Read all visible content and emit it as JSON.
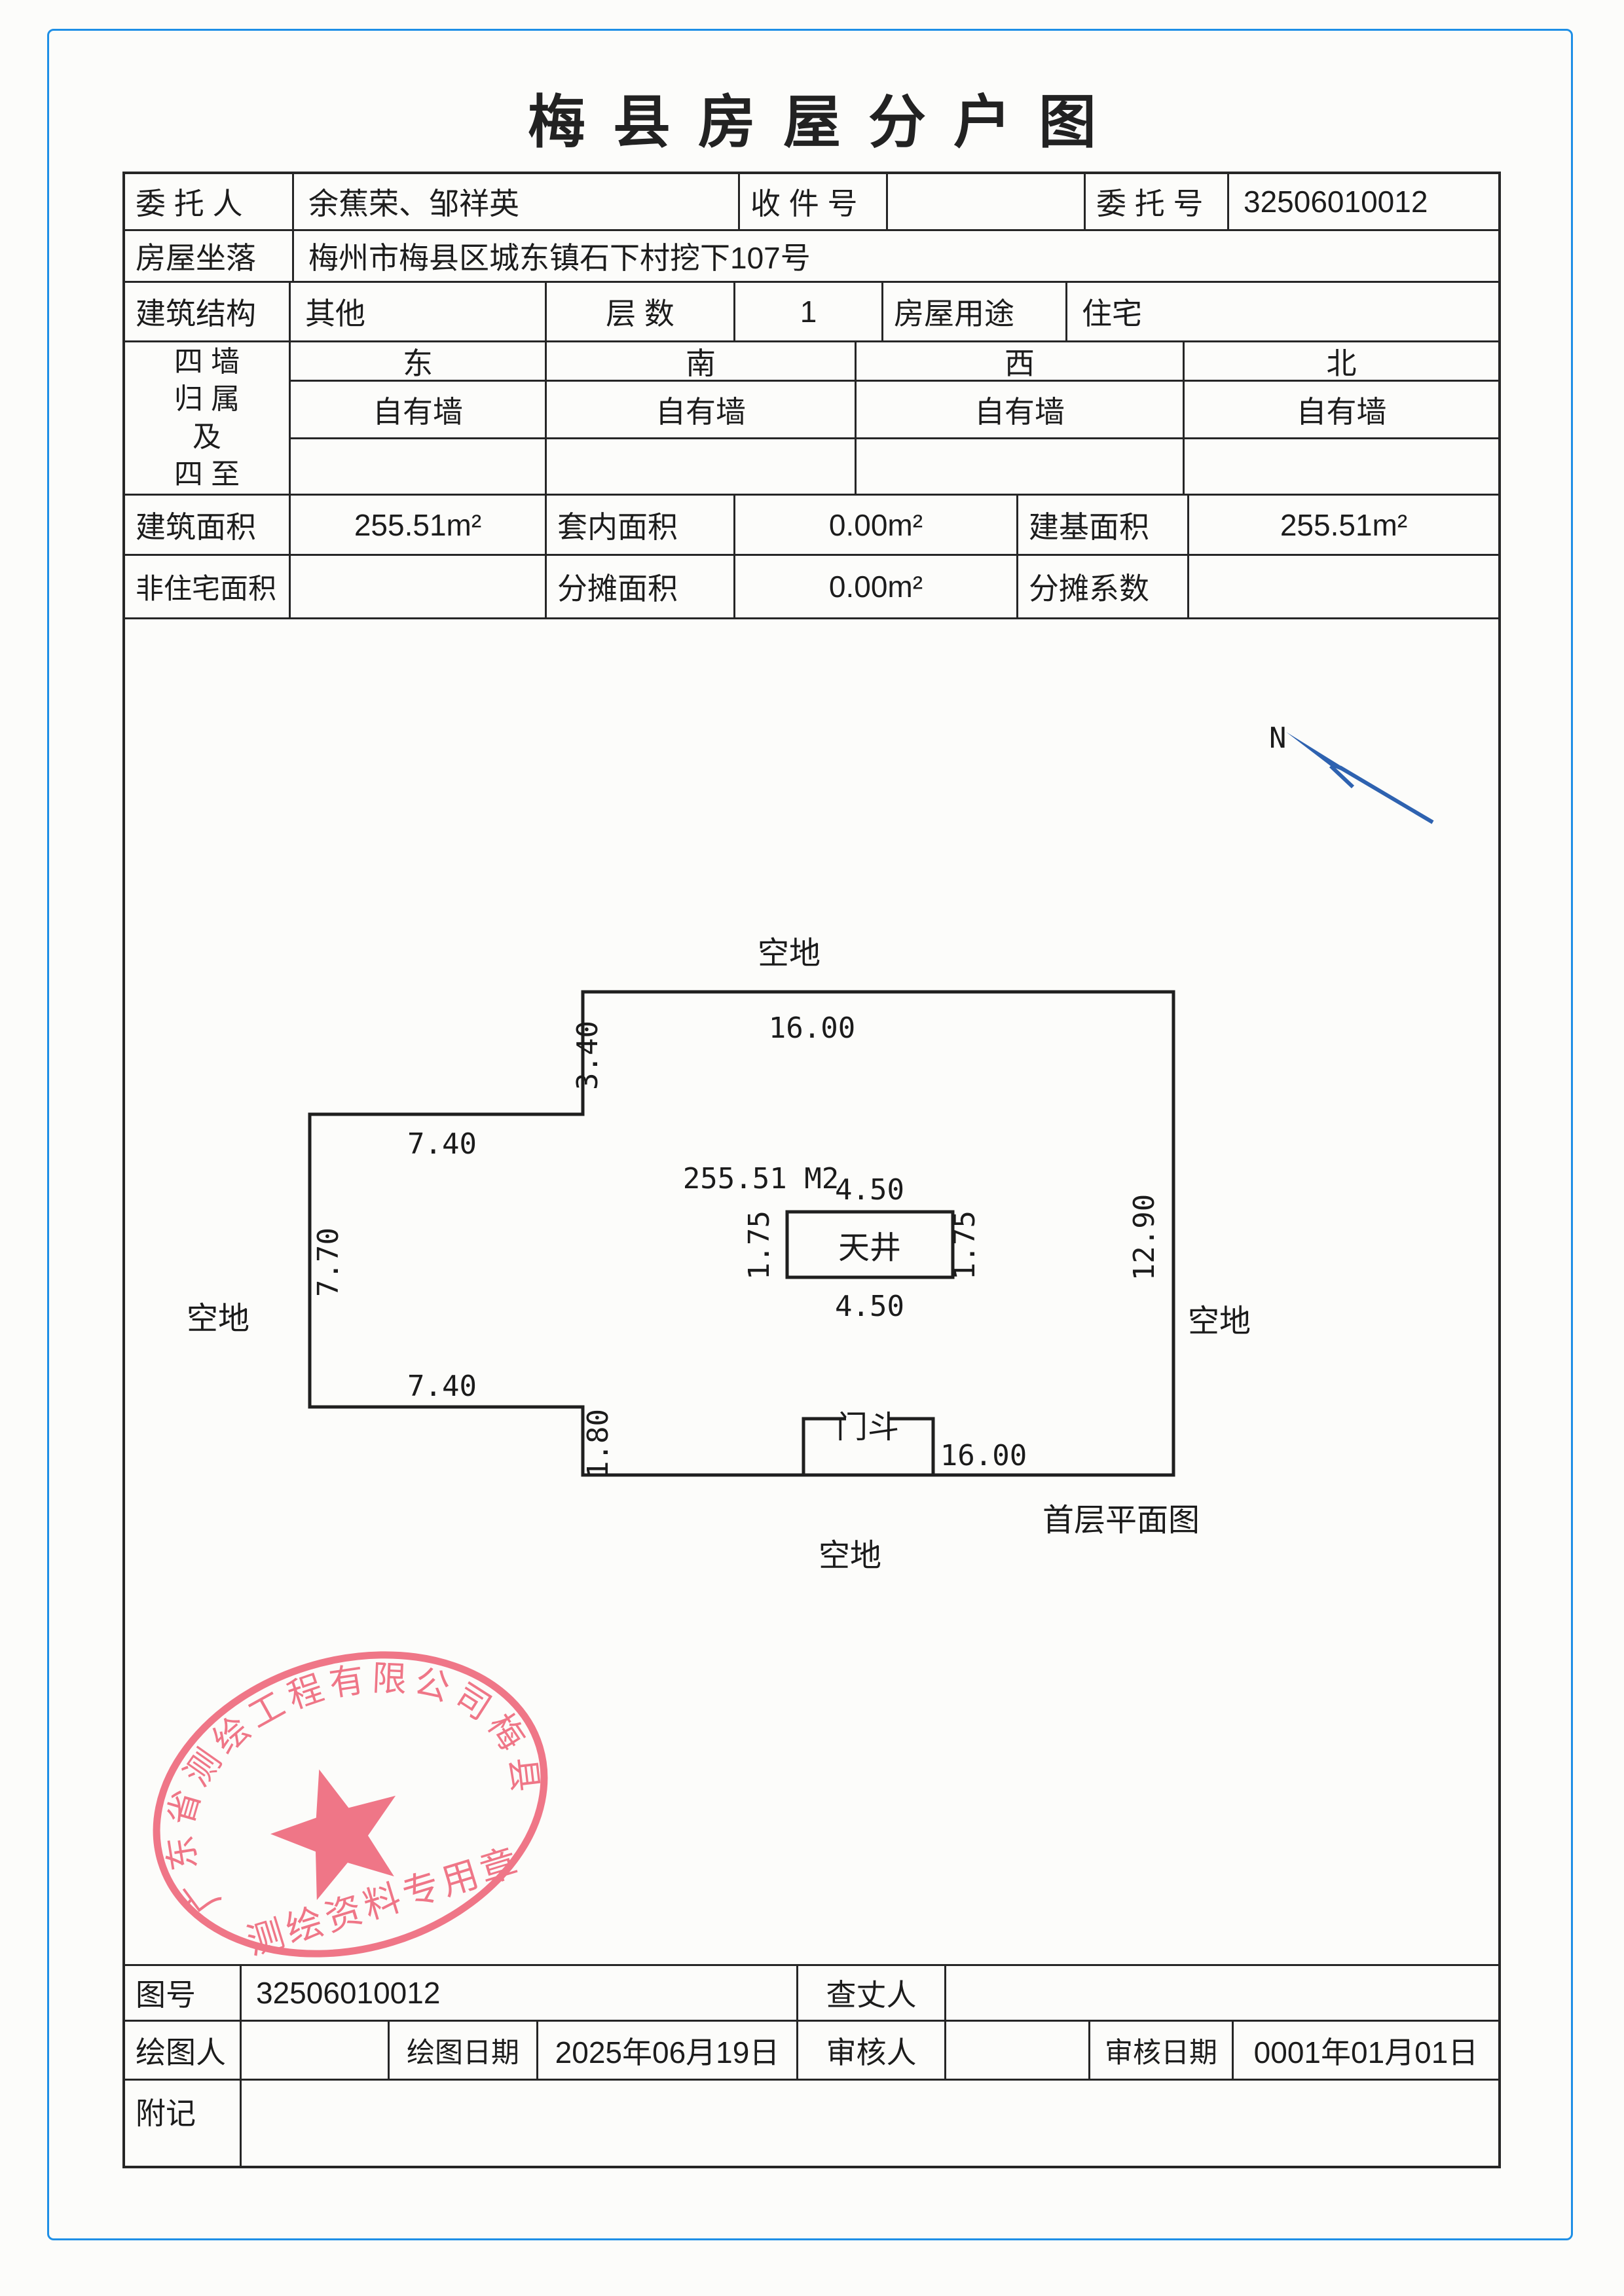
{
  "title": "梅县房屋分户图",
  "top_table": {
    "weituoren_label": "委 托 人",
    "weituoren_value": "余蕉荣、邹祥英",
    "shoujianhao_label": "收 件 号",
    "shoujianhao_value": "",
    "weituohao_label": "委 托 号",
    "weituohao_value": "32506010012",
    "zuoluo_label": "房屋坐落",
    "zuoluo_value": "梅州市梅县区城东镇石下村挖下107号",
    "jiegou_label": "建筑结构",
    "jiegou_value": "其他",
    "cengshu_label": "层  数",
    "cengshu_value": "1",
    "yongtu_label": "房屋用途",
    "yongtu_value": "住宅",
    "siqiang_label": "四 墙\n归 属\n及\n四 至",
    "directions": [
      "东",
      "南",
      "西",
      "北"
    ],
    "walls": [
      "自有墙",
      "自有墙",
      "自有墙",
      "自有墙"
    ],
    "empty_row": [
      "",
      "",
      "",
      ""
    ],
    "jianzhu_label": "建筑面积",
    "jianzhu_value": "255.51m²",
    "taonei_label": "套内面积",
    "taonei_value": "0.00m²",
    "jianji_label": "建基面积",
    "jianji_value": "255.51m²",
    "feizhuzhai_label": "非住宅面积",
    "feizhuzhai_value": "",
    "fentan_mianji_label": "分摊面积",
    "fentan_mianji_value": "0.00m²",
    "fentan_xishu_label": "分摊系数",
    "fentan_xishu_value": ""
  },
  "plan": {
    "north_label": "N",
    "area_label": "255.51 M2",
    "tianjing_label": "天井",
    "mendou_label": "门斗",
    "caption": "首层平面图",
    "kongdi_top": "空地",
    "kongdi_left": "空地",
    "kongdi_right": "空地",
    "kongdi_bottom": "空地",
    "dims": {
      "top": "16.00",
      "left_upper": "3.40",
      "wing_top": "7.40",
      "wing_left": "7.70",
      "wing_bottom": "7.40",
      "left_lower": "1.80",
      "right": "12.90",
      "bottom": "16.00",
      "tj_top": "4.50",
      "tj_bottom": "4.50",
      "tj_left": "1.75",
      "tj_right": "1.75"
    }
  },
  "stamp": {
    "ring_text": "广东省测绘工程有限公司梅县区不动产",
    "bottom_text": "测绘资料专用章",
    "color": "#ed5f74"
  },
  "bottom_table": {
    "tuhao_label": "图号",
    "tuhao_value": "32506010012",
    "chazhangren_label": "查丈人",
    "chazhangren_value": "",
    "huituren_label": "绘图人",
    "huituren_value": "",
    "huitu_date_label": "绘图日期",
    "huitu_date_value": "2025年06月19日",
    "shenheren_label": "审核人",
    "shenheren_value": "",
    "shenhe_date_label": "审核日期",
    "shenhe_date_value": "0001年01月01日",
    "fuji_label": "附记",
    "fuji_value": ""
  },
  "colors": {
    "border_blue": "#1e8fe6",
    "arrow_blue": "#2e62b0",
    "stamp_red": "#ed5f74",
    "line_dark": "#262626"
  }
}
